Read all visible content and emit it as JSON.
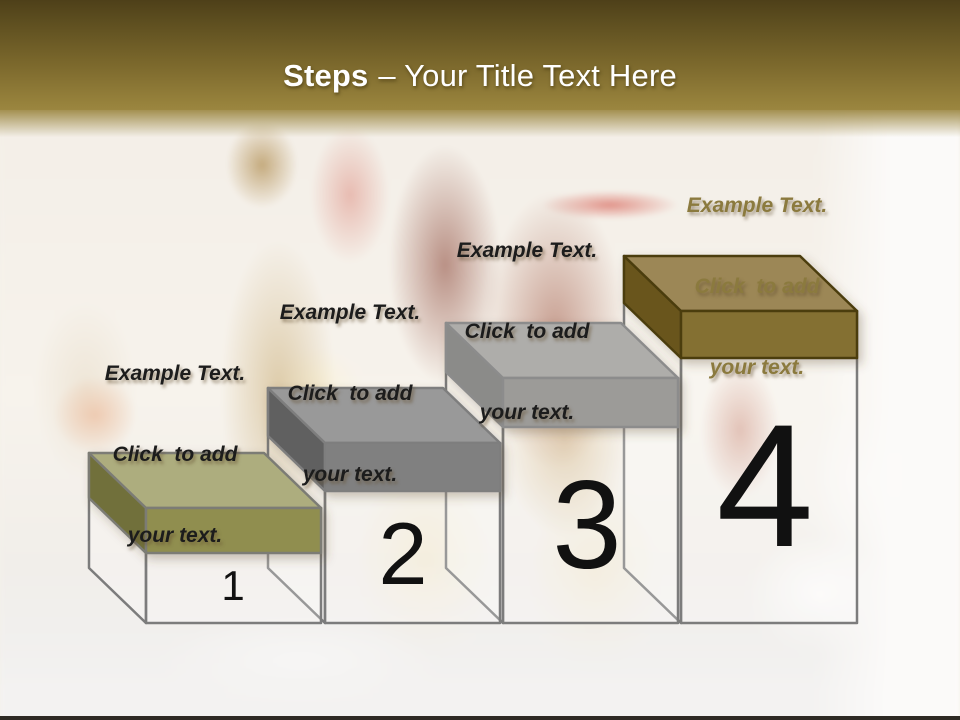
{
  "header": {
    "title_bold": "Steps",
    "title_rest": "– Your Title Text Here",
    "text_color": "#ffffff",
    "band_top_color": "#4e4019",
    "band_bottom_color": "#9b8640"
  },
  "steps": [
    {
      "number": "1",
      "label_lines": [
        "Example Text.",
        "Click  to add",
        "your text."
      ],
      "label_color": "#1c1c1c",
      "colors": {
        "top": "#adad7e",
        "front": "#908e4f",
        "left": "#71703a",
        "border": "#7c7c74"
      }
    },
    {
      "number": "2",
      "label_lines": [
        "Example Text.",
        "Click  to add",
        "your text."
      ],
      "label_color": "#1c1c1c",
      "colors": {
        "top": "#999999",
        "front": "#808080",
        "left": "#606060",
        "border": "#7e7e7e"
      }
    },
    {
      "number": "3",
      "label_lines": [
        "Example Text.",
        "Click  to add",
        "your text."
      ],
      "label_color": "#1c1c1c",
      "colors": {
        "top": "#aeadaa",
        "front": "#9c9b98",
        "left": "#8b8b89",
        "border": "#8c8c8c"
      }
    },
    {
      "number": "4",
      "label_lines": [
        "Example Text.",
        "Click  to add",
        "your text."
      ],
      "label_color": "#8b7a3e",
      "colors": {
        "top": "#9c8756",
        "front": "#847030",
        "left": "#69551e",
        "border": "#4c3e10"
      }
    }
  ],
  "canvas": {
    "bottom_bar_color": "#2e2a24"
  }
}
